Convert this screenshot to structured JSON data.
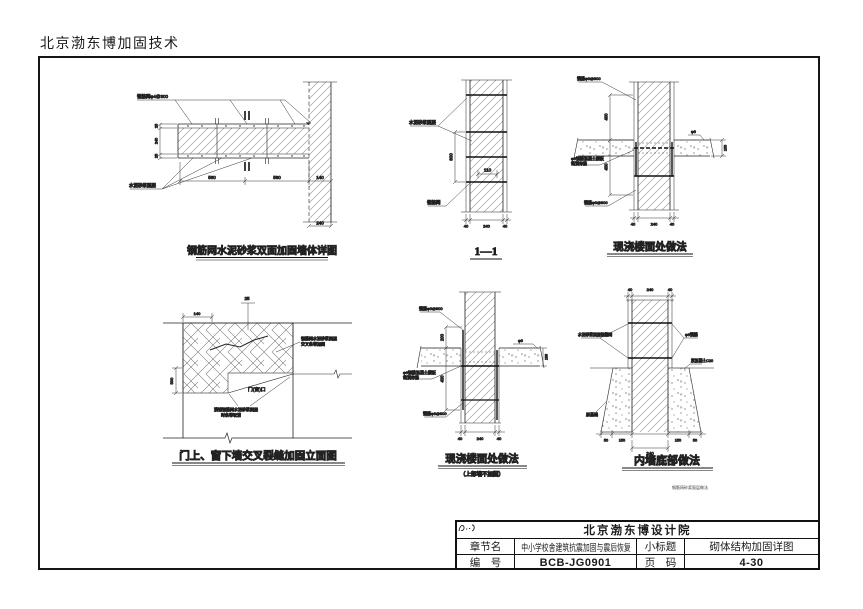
{
  "page": {
    "header": "北京渤东博加固技术",
    "corner_note": "钢筋网砂浆面层做法"
  },
  "titleblock": {
    "company": "北京渤东博设计院",
    "chapter_label": "章节名",
    "chapter_value": "中小学校舍建筑抗震加固与震后恢复",
    "subtitle_label": "小标题",
    "subtitle_value": "砌体结构加固详图",
    "number_label": "编　号",
    "number_value": "BCB-JG0901",
    "pagecode_label": "页　码",
    "pagecode_value": "4-30"
  },
  "d1": {
    "caption": "钢筋网水泥砂浆双面加固墙体详图",
    "label_mesh": "钢筋网φ4@300",
    "label_mortar": "水泥砂浆面层",
    "dim_wall": "240",
    "dims_bottom": [
      "560",
      "560",
      "140"
    ],
    "dims_left": [
      "25",
      "240",
      "25"
    ]
  },
  "d2": {
    "caption": "1—1",
    "label_mortar": "水泥砂浆面层",
    "label_mesh": "钢筋网",
    "dim_v": "600",
    "dim_h": "110",
    "dims_bottom": [
      "40",
      "240",
      "40"
    ]
  },
  "d3": {
    "caption": "现浇楼面处做法",
    "label_top": "锚筋φ6@900",
    "label_mid1": "φ6钢筋混凝土楼板",
    "label_mid2": "凿洞穿筋",
    "label_bottom": "锚筋φ6@900",
    "label_slab": "φ6",
    "dim_v1": "400",
    "dim_v2": "400",
    "dim_r": "100",
    "dims_bottom": [
      "40",
      "240",
      "40"
    ]
  },
  "d4": {
    "caption": "门上、窗下墙交叉裂缝加固立面图",
    "label_top": "25",
    "note_r1": "钢筋网水泥砂浆面层",
    "note_r2": "交叉条带加固",
    "note_b1": "满铺钢筋网水泥砂浆面层",
    "note_b2": "时条带取消",
    "label_open": "门(窗)口",
    "dim_top": "140",
    "dim_left": "500"
  },
  "d5": {
    "caption": "现浇楼面处做法",
    "subcaption": "（上部墙不加固）",
    "label_top": "锚筋φ6@900",
    "label_mid1": "φ6钢筋混凝土楼板",
    "label_mid2": "凿洞穿筋",
    "label_bottom": "锚筋φ6@900",
    "label_slab": "φ6",
    "dim_v1": "200",
    "dim_v2": "400",
    "dim_r": "100",
    "dims_bottom": [
      "40",
      "240",
      "40"
    ]
  },
  "d6": {
    "caption": "内墙底部做法",
    "label_left": "水泥砂浆面层钢筋网",
    "label_right": "φ6锚筋",
    "label_ground": "素混凝土C20",
    "label_found": "原基础",
    "dims_top": [
      "40",
      "240",
      "40"
    ],
    "dims_bottom": [
      "50",
      "150",
      "150",
      "50"
    ],
    "dim_b": "240"
  }
}
